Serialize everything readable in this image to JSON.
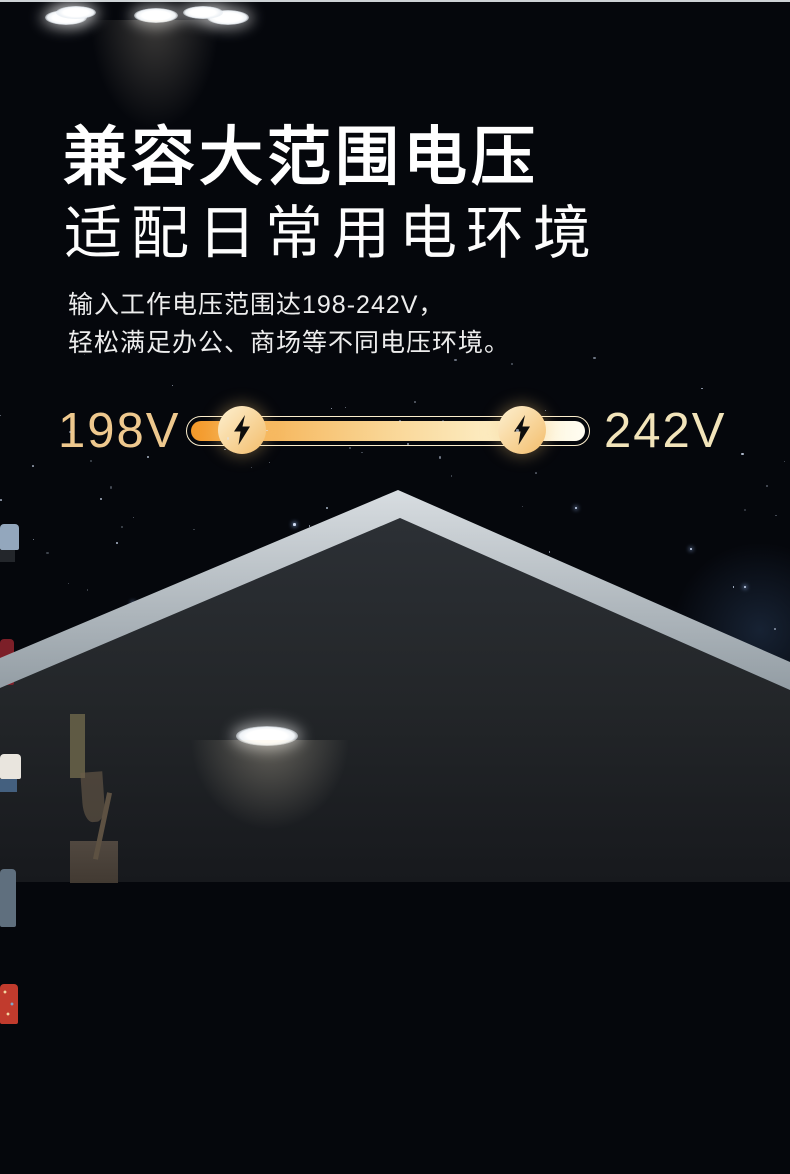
{
  "header": {
    "title": "兼容大范围电压",
    "subtitle": "适配日常用电环境",
    "description_line1": "输入工作电压范围达198-242V，",
    "description_line2": "轻松满足办公、商场等不同电压环境。"
  },
  "voltage": {
    "min_label": "198V",
    "max_label": "242V",
    "min_value": 198,
    "max_value": 242,
    "unit": "V",
    "range_text": "198-242V",
    "bolt_icon": "lightning-bolt"
  },
  "colors": {
    "background": "#05070c",
    "title_text": "#ffffff",
    "body_text": "#ededed",
    "gold_label_min": "#eec88e",
    "gold_label_max": "#f2e4ba",
    "bar_outline": "#fceecd",
    "bar_gradient": [
      "#f3992a",
      "#f6b55a",
      "#f9d492",
      "#fcecc2",
      "#fffdf2"
    ],
    "badge_gradient": [
      "#fdf0d0",
      "#f3bd6b"
    ],
    "bolt": "#0d0d0d",
    "roof": "#c7ced3",
    "feature_wall": "#6d8293",
    "floor_band": "#9db1c0"
  },
  "scene": {
    "label": "house-cross-section-night",
    "rooms": [
      "closet-room",
      "feature-wall-room",
      "meeting-room",
      "shop-window"
    ],
    "lights_count": 7
  }
}
